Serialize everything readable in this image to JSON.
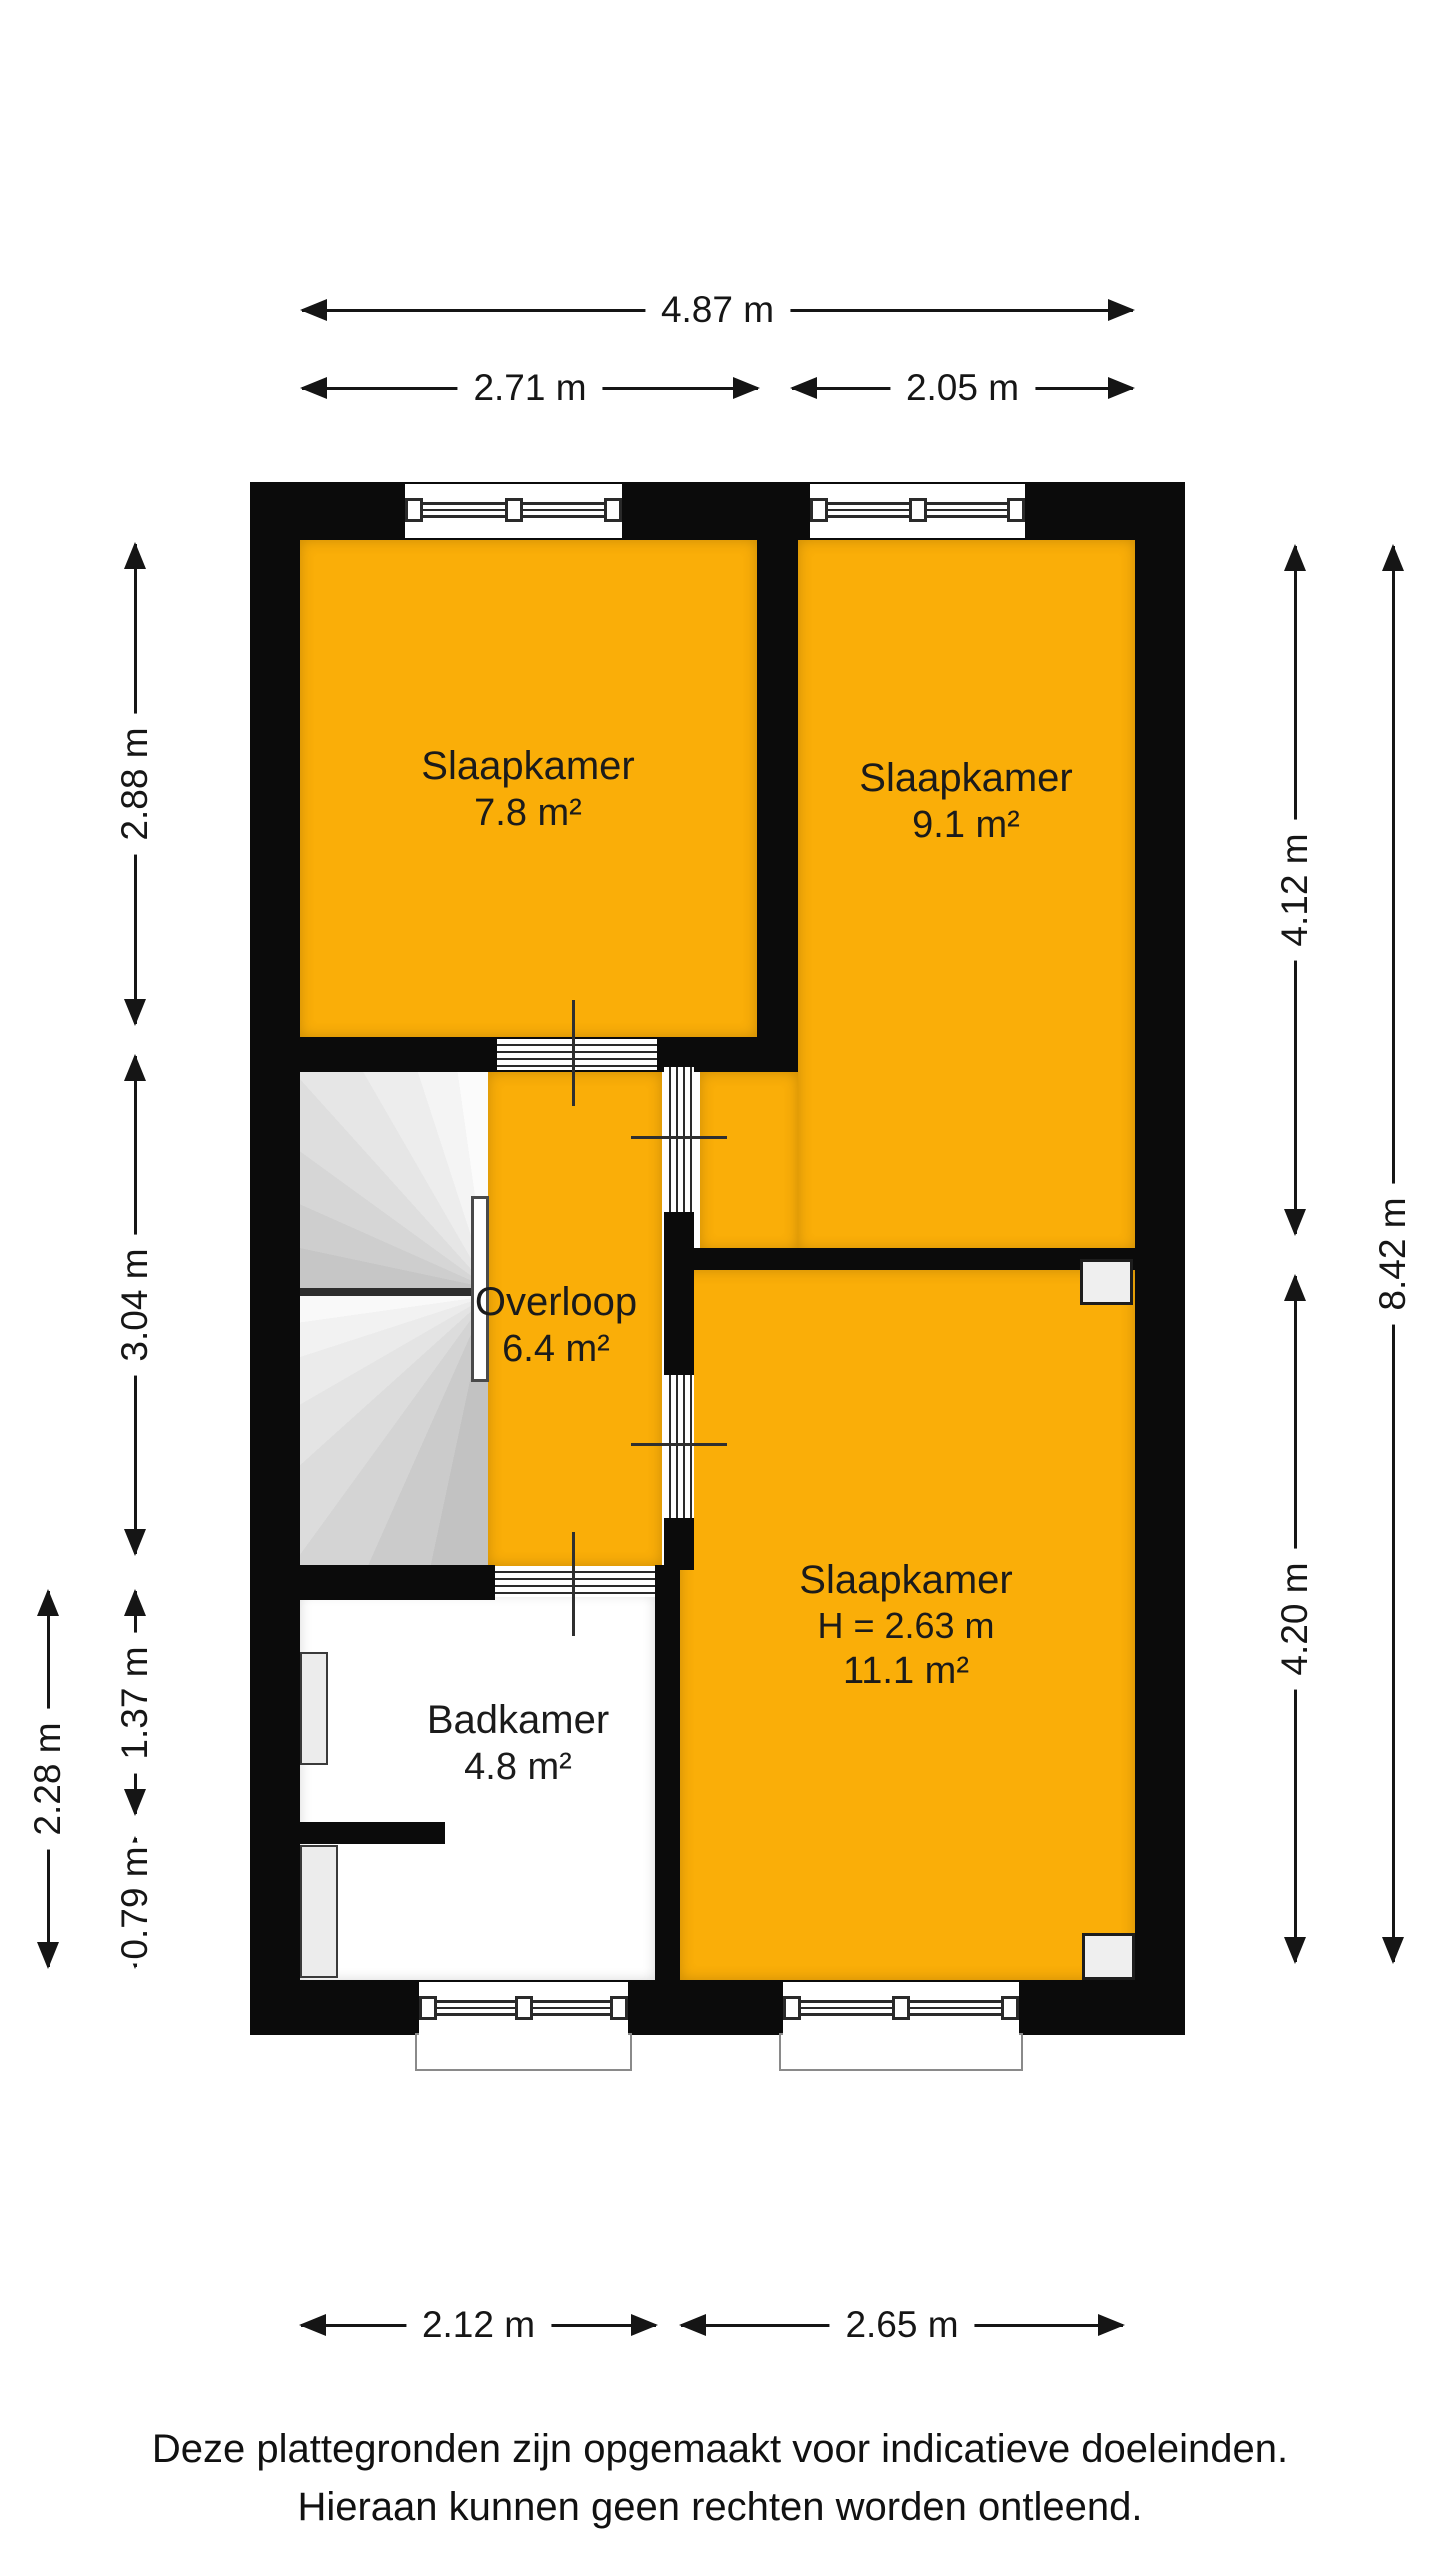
{
  "rooms": [
    {
      "name": "Slaapkamer",
      "area": "7.8 m²"
    },
    {
      "name": "Slaapkamer",
      "area": "9.1 m²"
    },
    {
      "name": "Overloop",
      "area": "6.4 m²"
    },
    {
      "name": "Slaapkamer",
      "ceiling_height": "H = 2.63 m",
      "area": "11.1 m²"
    },
    {
      "name": "Badkamer",
      "area": "4.8 m²"
    }
  ],
  "dimensions": {
    "top_total": "4.87 m",
    "top_left": "2.71 m",
    "top_right": "2.05 m",
    "left_upper": "2.88 m",
    "left_middle": "3.04 m",
    "left_lower_inner_upper": "1.37 m",
    "left_lower_inner_lower": "0.79 m",
    "left_lower_outer": "2.28 m",
    "right_upper": "4.12 m",
    "right_lower": "4.20 m",
    "right_total": "8.42 m",
    "bottom_left": "2.12 m",
    "bottom_right": "2.65 m"
  },
  "disclaimer": {
    "line1": "Deze plattegronden zijn opgemaakt voor indicatieve doeleinden.",
    "line2": "Hieraan kunnen geen rechten worden ontleend."
  },
  "colors": {
    "room_fill": "#FAAE08",
    "wall": "#0B0B0B"
  }
}
